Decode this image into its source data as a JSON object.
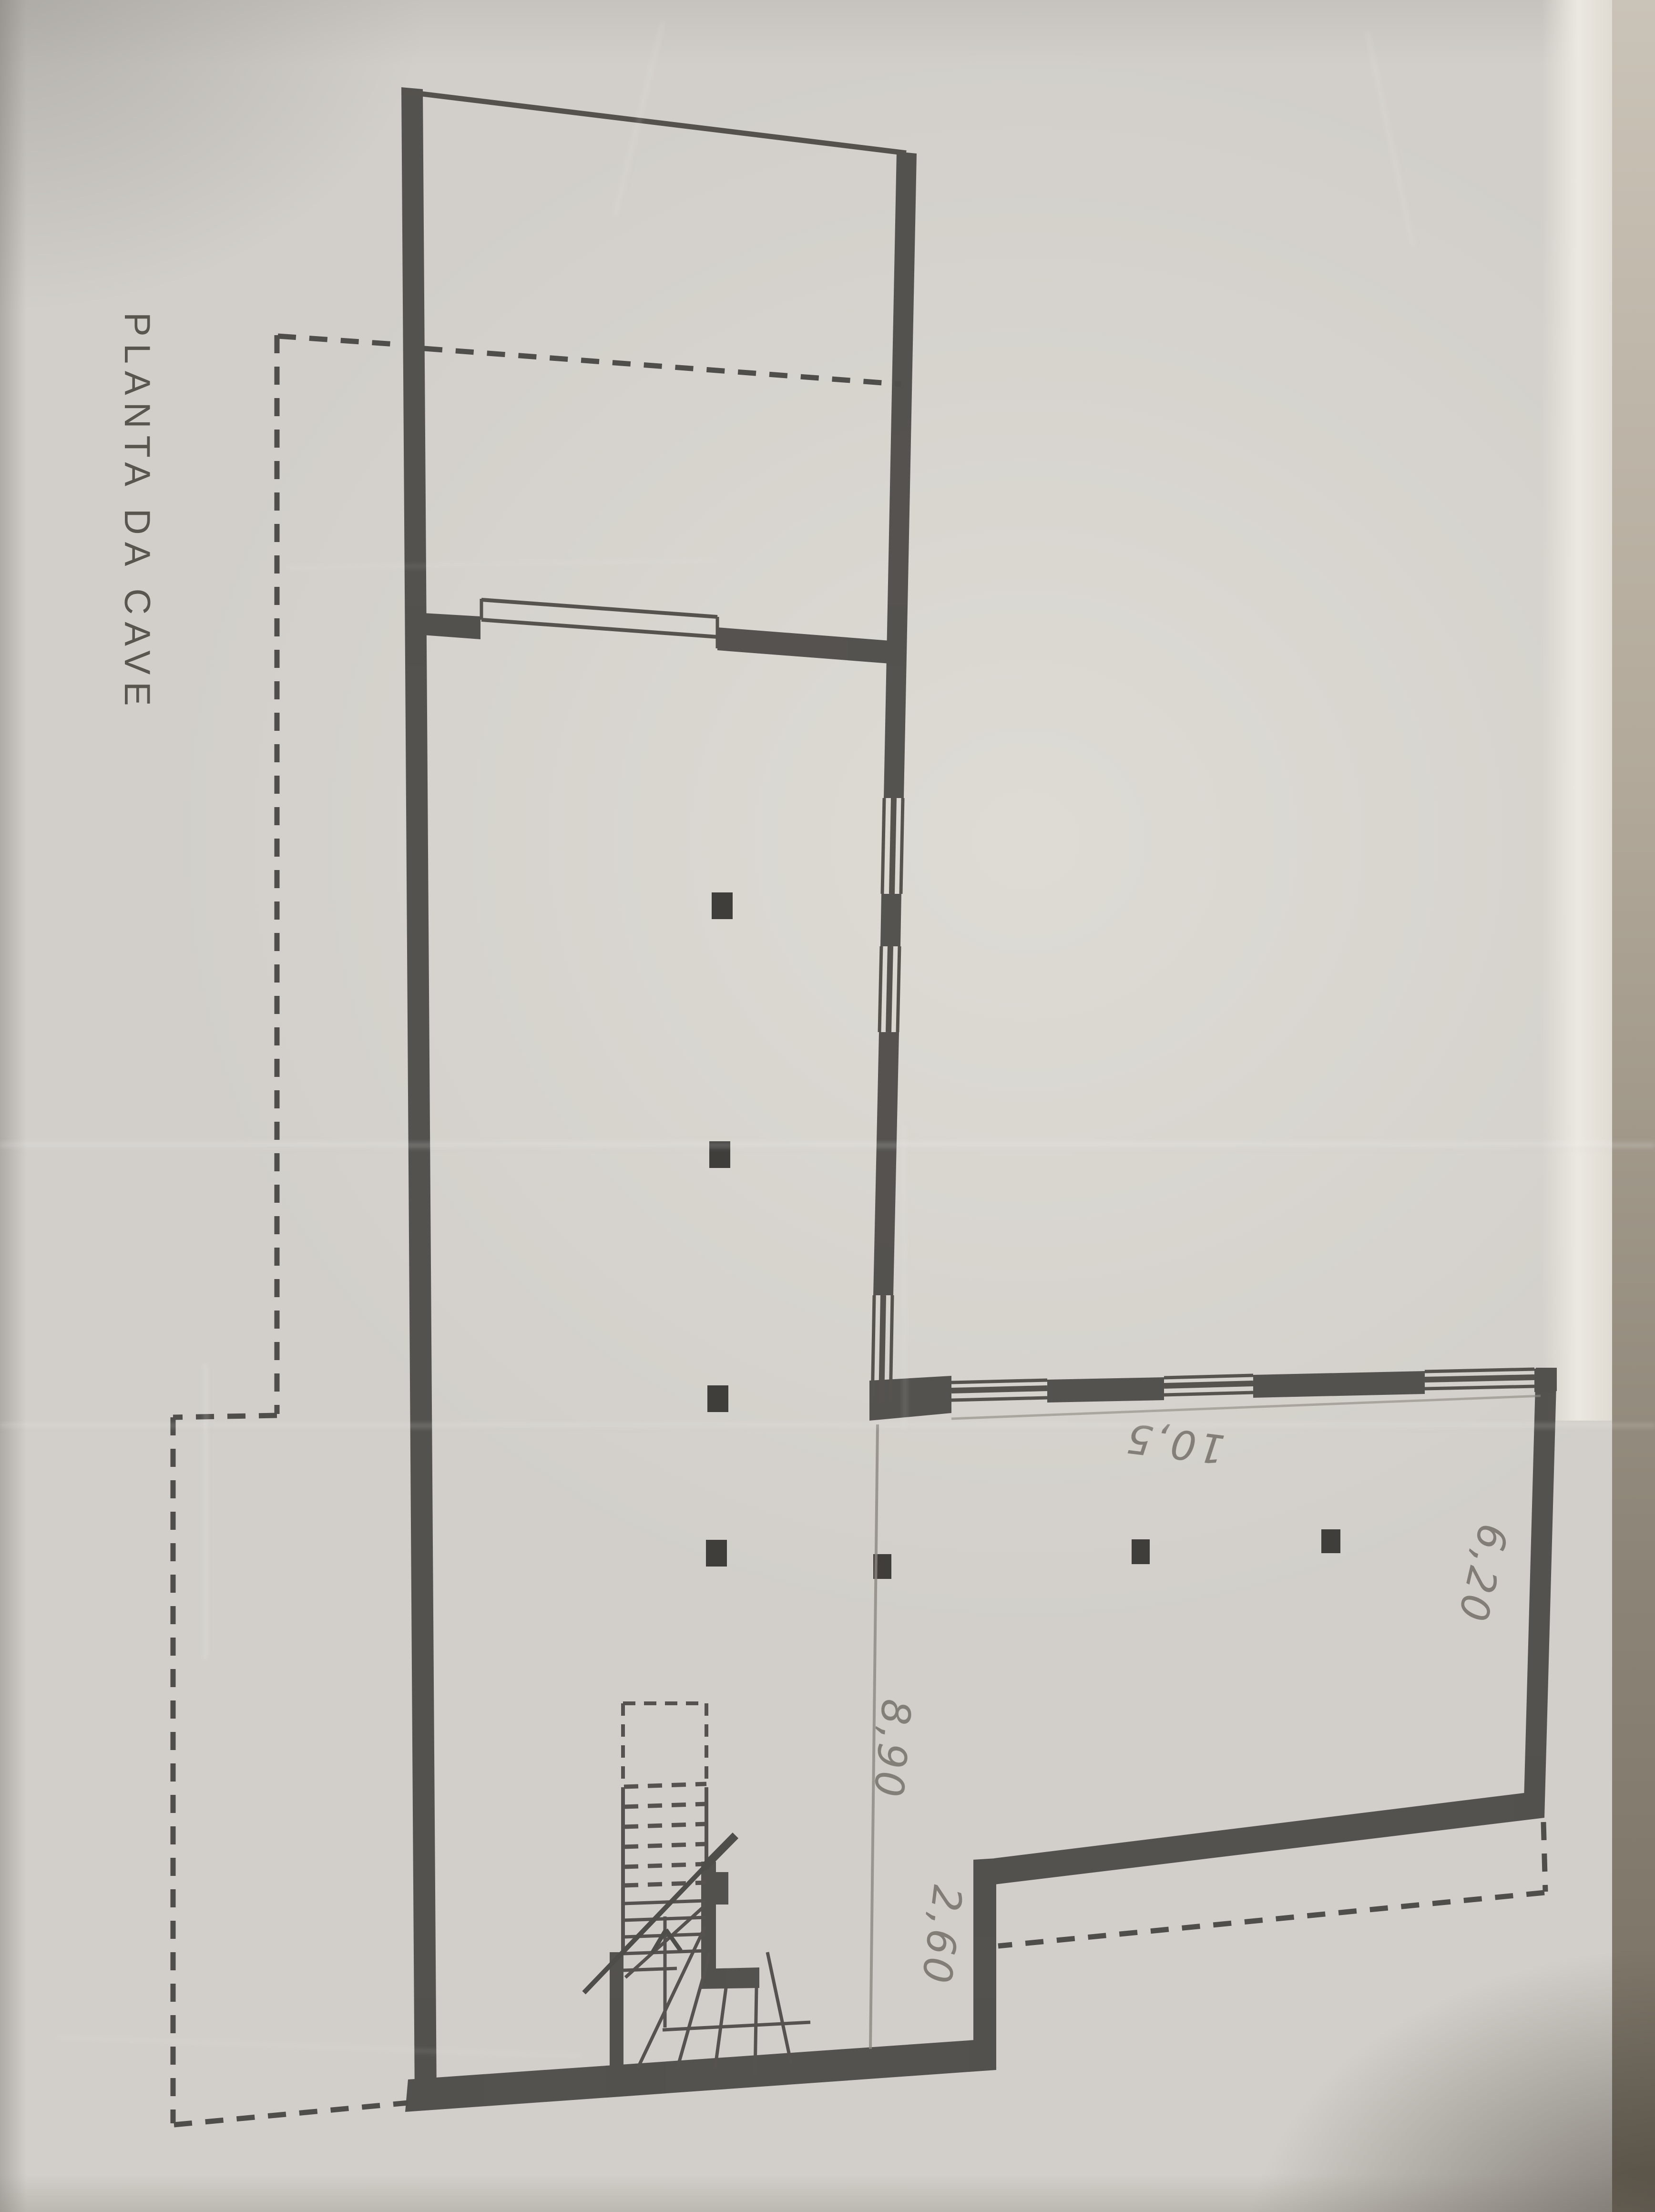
{
  "photo": {
    "kind": "photograph of a pencil-and-ink architectural drawing",
    "paper_color": "#d2cfca",
    "ink_color": "#4a4845",
    "pencil_color": "#6f6a63",
    "shadow_corner_color": "#756e61",
    "highlight_strip_color": "#ebe8e1"
  },
  "drawing": {
    "title": "PLANTA DA CAVE"
  },
  "dimensions": {
    "d890": "8,90",
    "d260": "2,60",
    "d620": "6,20",
    "d105": "10,5"
  }
}
